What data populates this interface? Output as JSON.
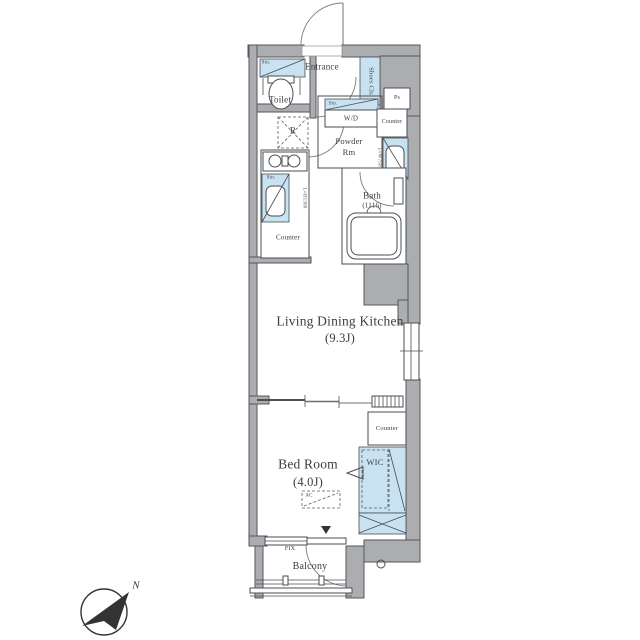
{
  "labels": {
    "entrance": "Entrance",
    "toilet": "Toilet",
    "toilet_storage": "Sto.",
    "shoes_closet": "Shoes Cls",
    "washer_storage": "Sto.",
    "washer_dryer": "W/D",
    "pipe_space": "Ps",
    "counter_powder": "Counter",
    "powder_room_1": "Powder",
    "powder_room_2": "Rm",
    "basin_dim": "L=W750",
    "bath": "Bath",
    "bath_size": "(1116)",
    "refrigerator": "R",
    "sink": "Sin.",
    "kitchen_dim": "L=H1300",
    "kitchen_counter": "Counter",
    "ldk_1": "Living Dining Kitchen",
    "ldk_2": "(9.3J)",
    "counter_bedroom": "Counter",
    "bedroom_1": "Bed Room",
    "bedroom_2": "(4.0J)",
    "wic": "WIC",
    "ac": "AC",
    "fix_window": "FIX",
    "balcony": "Balcony",
    "compass_north": "N"
  },
  "colors": {
    "wall": "#abadb1",
    "fixture_blue": "#c9e2f1",
    "line": "#4b4e52",
    "text": "#35373a"
  }
}
